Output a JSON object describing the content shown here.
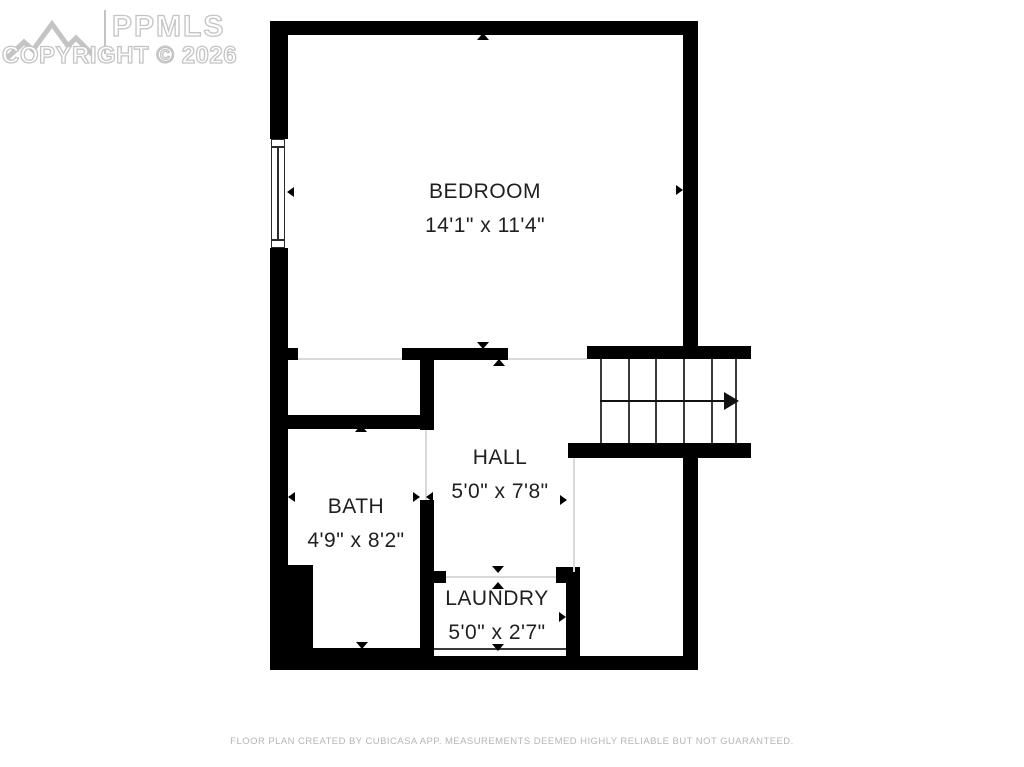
{
  "watermark": {
    "brand": "PPMLS",
    "copyright": "COPYRIGHT © 2026"
  },
  "rooms": {
    "bedroom": {
      "name": "BEDROOM",
      "dimensions": "14'1\" x 11'4\""
    },
    "hall": {
      "name": "HALL",
      "dimensions": "5'0\" x 7'8\""
    },
    "bath": {
      "name": "BATH",
      "dimensions": "4'9\" x 8'2\""
    },
    "laundry": {
      "name": "LAUNDRY",
      "dimensions": "5'0\" x 2'7\""
    }
  },
  "stairs": {
    "steps": 6,
    "direction": "right"
  },
  "footer": {
    "disclaimer": "FLOOR PLAN CREATED BY CUBICASA APP. MEASUREMENTS DEEMED HIGHLY RELIABLE BUT NOT GUARANTEED."
  },
  "colors": {
    "wall": "#000000",
    "watermark_gray": "#c4c4c4",
    "label_text": "#1f1f1f",
    "footer_text": "#b5b5b5"
  }
}
